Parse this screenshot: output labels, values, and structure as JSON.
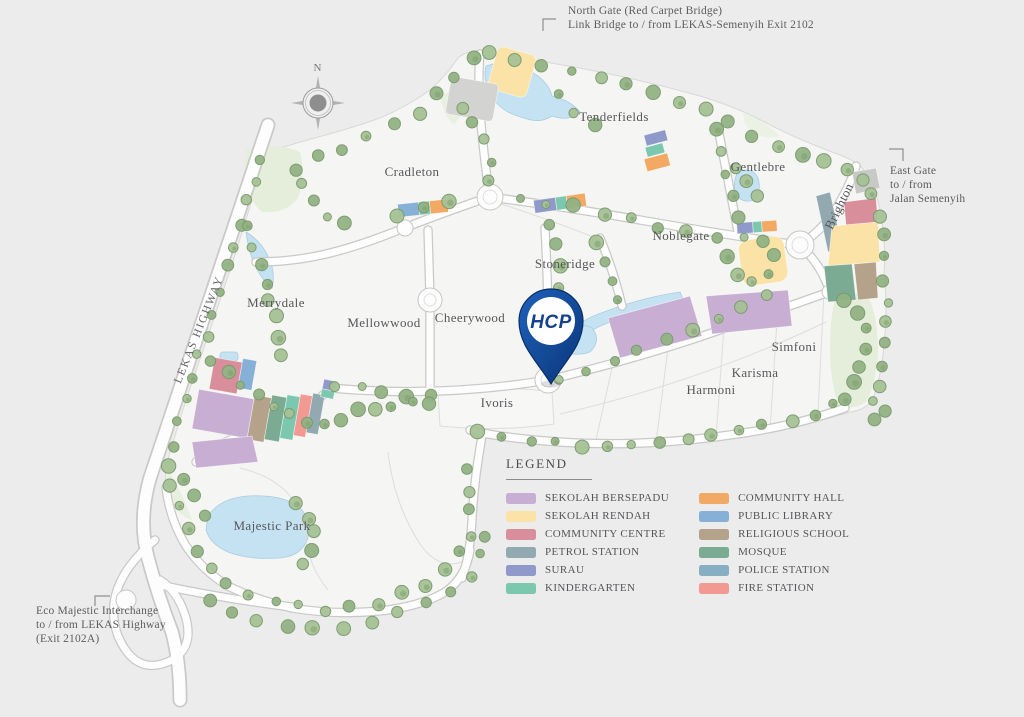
{
  "neighborhoods": {
    "tenderfields": "Tenderfields",
    "cradleton": "Cradleton",
    "gentlebre": "Gentlebre",
    "noblegate": "Noblegate",
    "stoneridge": "Stoneridge",
    "merrydale": "Merrydale",
    "mellowwood": "Mellowwood",
    "cheerywood": "Cheerywood",
    "ivoris": "Ivoris",
    "harmoni": "Harmoni",
    "karisma": "Karisma",
    "simfoni": "Simfoni",
    "majestic_park": "Majestic Park",
    "brighton": "Brighton"
  },
  "roads": {
    "lekas_highway": "LEKAS HIGHWAY"
  },
  "compass": {
    "north": "N"
  },
  "gates": {
    "north_gate": {
      "line1": "North Gate (Red Carpet Bridge)",
      "line2": "Link Bridge to / from LEKAS-Semenyih Exit 2102"
    },
    "east_gate": {
      "line1": "East Gate",
      "line2": "to / from",
      "line3": "Jalan Semenyih"
    },
    "interchange": {
      "line1": "Eco Majestic Interchange",
      "line2": "to / from LEKAS Highway",
      "line3": "(Exit 2102A)"
    }
  },
  "pin": {
    "label": "HCP",
    "color": "#11418f"
  },
  "legend": {
    "title": "LEGEND",
    "items": [
      {
        "label": "SEKOLAH BERSEPADU",
        "color": "#c9aed3"
      },
      {
        "label": "SEKOLAH RENDAH",
        "color": "#fbe2a7"
      },
      {
        "label": "COMMUNITY CENTRE",
        "color": "#d88e9b"
      },
      {
        "label": "PETROL STATION",
        "color": "#93a9b2"
      },
      {
        "label": "SURAU",
        "color": "#8f9aca"
      },
      {
        "label": "KINDERGARTEN",
        "color": "#7bc8af"
      },
      {
        "label": "COMMUNITY HALL",
        "color": "#f2a964"
      },
      {
        "label": "PUBLIC LIBRARY",
        "color": "#87b0d7"
      },
      {
        "label": "RELIGIOUS SCHOOL",
        "color": "#b5a28b"
      },
      {
        "label": "MOSQUE",
        "color": "#7cab94"
      },
      {
        "label": "POLICE STATION",
        "color": "#88aec2"
      },
      {
        "label": "FIRE STATION",
        "color": "#f29a92"
      }
    ]
  }
}
